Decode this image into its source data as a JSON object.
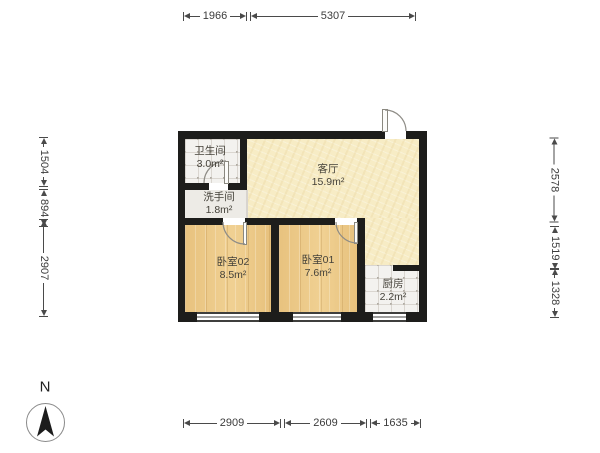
{
  "compass": {
    "north_label": "N"
  },
  "rooms": {
    "bathroom": {
      "name": "卫生间",
      "area": "3.0m²"
    },
    "washroom": {
      "name": "洗手间",
      "area": "1.8m²"
    },
    "living_room": {
      "name": "客厅",
      "area": "15.9m²"
    },
    "bedroom02": {
      "name": "卧室02",
      "area": "8.5m²"
    },
    "bedroom01": {
      "name": "卧室01",
      "area": "7.6m²"
    },
    "kitchen": {
      "name": "厨房",
      "area": "2.2m²"
    }
  },
  "dimensions_mm": {
    "top": [
      "1966",
      "5307"
    ],
    "bottom": [
      "2909",
      "2609",
      "1635"
    ],
    "left": [
      "1504",
      "894",
      "2907"
    ],
    "right": [
      "2578",
      "1519",
      "1328"
    ]
  },
  "colors": {
    "wall": "#1d1d1b",
    "wood_floor": "#ecca88",
    "living_floor": "#f7ecc5",
    "tile_floor": "#f3f2ef",
    "dimension_line": "#4a4a4a"
  }
}
